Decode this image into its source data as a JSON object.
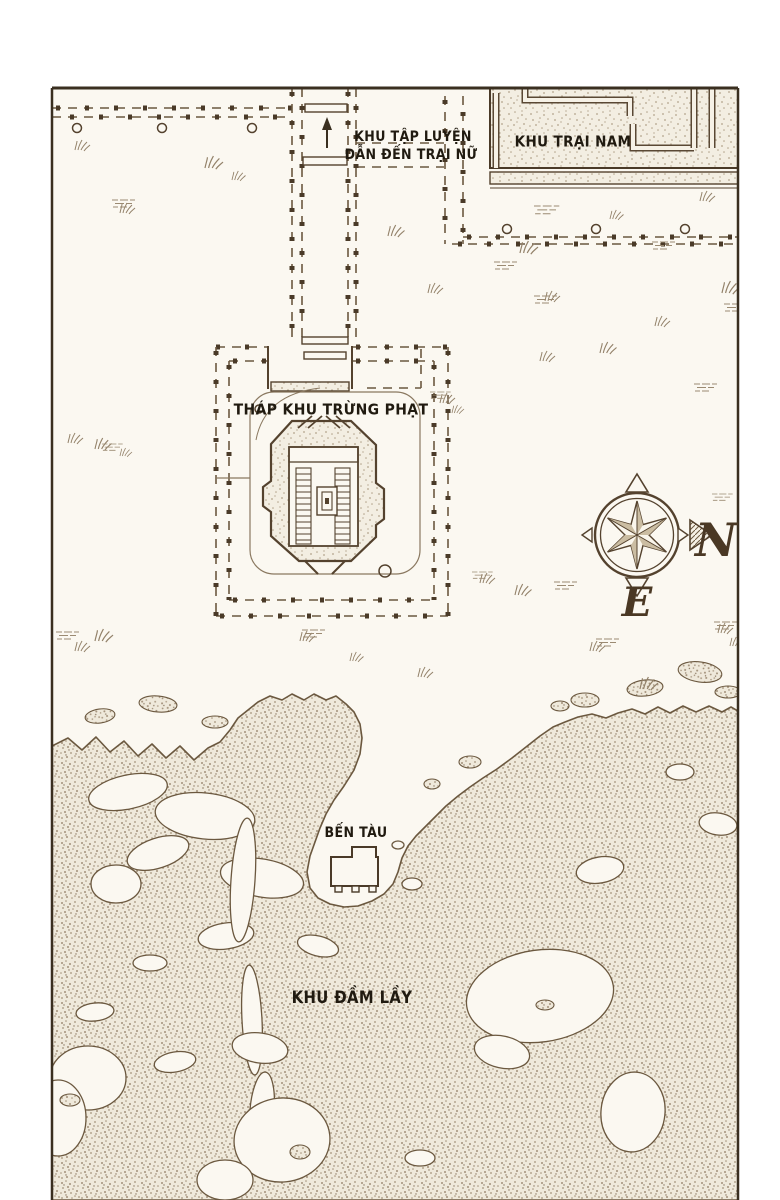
{
  "map": {
    "labels": {
      "training_area_line1": "KHU TẬP LUYỆN",
      "training_area_line2": "DẪN ĐẾN TRẠI NỮ",
      "south_camp": "KHU TRẠI NAM",
      "punishment_tower": "THÁP KHU TRỪNG PHẠT",
      "dock": "BẾN TÀU",
      "swamp": "KHU ĐẦM LẦY"
    },
    "compass": {
      "north_label": "N",
      "east_label": "E"
    },
    "colors": {
      "paper": "#fbf8f1",
      "ink": "#5d4a33",
      "frame": "#3a2f20",
      "stipple": "#a3917a",
      "label_text": "#201a10"
    }
  }
}
